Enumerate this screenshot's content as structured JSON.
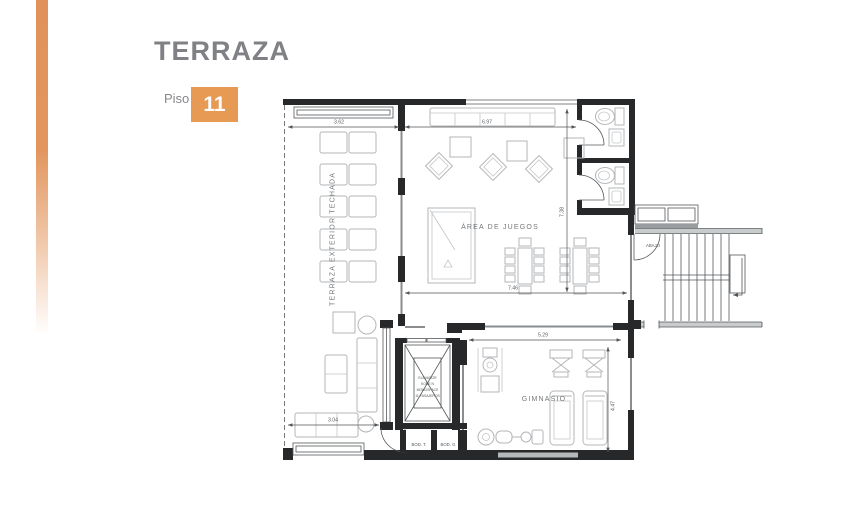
{
  "header": {
    "title": "TERRAZA",
    "floor_label": "Piso",
    "floor_number": "11",
    "title_color": "#7f8184",
    "badge_color": "#e69a54",
    "stripe_color": "#e0925a"
  },
  "plan": {
    "labels": {
      "terraza_exterior": "TERRAZA EXTERIOR TECHADA",
      "area_de_juegos": "ÁREA DE JUEGOS",
      "gimnasio": "GIMNASIO",
      "abajo": "ABAJO",
      "bod_t": "BOD. T.",
      "bod_g": "BOD. G",
      "elevador_l1": "ELEVADOR",
      "elevador_l2": "KONE N",
      "elevador_l3": "MONOSPACE",
      "elevador_l4": "11 PASAJEROS"
    },
    "dimensions": {
      "terraza_top": "3.62",
      "juegos_top": "6.97",
      "juegos_width": "7.46",
      "juegos_height": "7.38",
      "gimnasio_width": "5.29",
      "gimnasio_height": "4.47",
      "estar_width": "3.04"
    }
  }
}
